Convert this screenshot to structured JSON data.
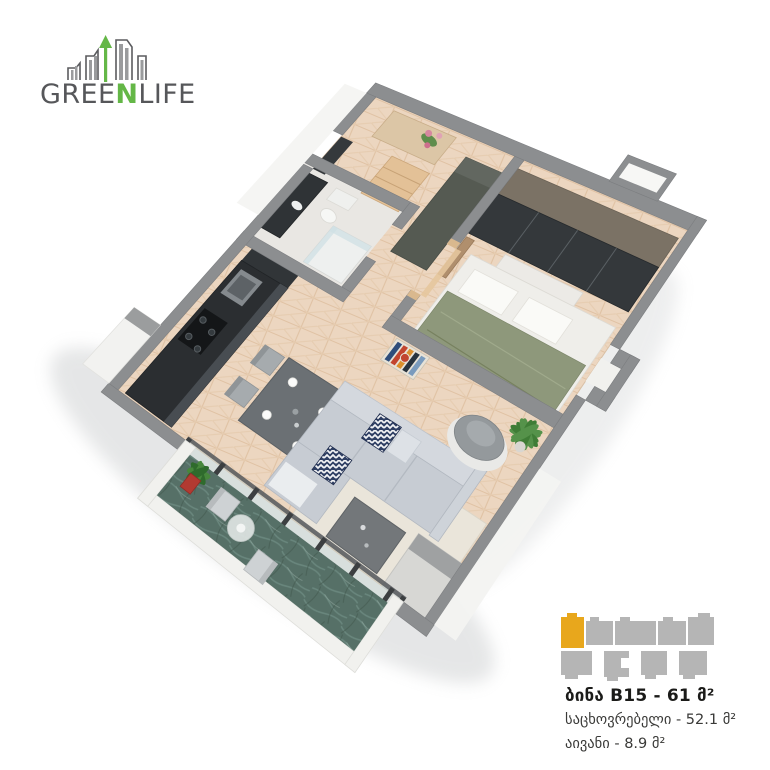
{
  "brand": {
    "prefix": "GREE",
    "accent": "N",
    "suffix": "LIFE"
  },
  "unit": {
    "title": "ბინა B15 - 61 მ²",
    "living": "საცხოვრებელი - 52.1 მ²",
    "balcony": "აივანი - 8.9 მ²",
    "unit_code": "B15"
  },
  "footprint": {
    "highlight_color": "#E8A71C",
    "block_color": "#B5B5B5"
  },
  "palette": {
    "wall_gray": "#8C8E90",
    "floor_wood": "#ECD6C0",
    "balcony_marble": "#567067",
    "logo_green": "#64B747",
    "logo_gray": "#56575A",
    "kitchen_dark": "#2B2E31",
    "bed_sage": "#8E987B",
    "sofa_gray": "#C7CCD3"
  }
}
